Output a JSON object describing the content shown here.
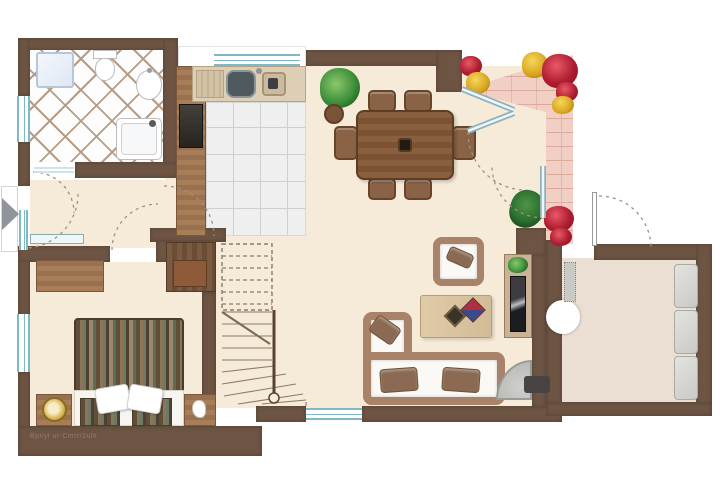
{
  "image_type": "residential ground-floor plan, top-down color rendering",
  "watermark": "Bpl/yl ur Cmrr/2ulk",
  "rooms": [
    {
      "name": "Bathroom",
      "features": [
        "shower cabin",
        "toilet",
        "washbasin",
        "bathtub",
        "diagonal tiled floor",
        "window"
      ]
    },
    {
      "name": "Kitchen",
      "features": [
        "sink counter with two basins",
        "window above counter",
        "tall cabinet column",
        "oven",
        "square tiled floor"
      ]
    },
    {
      "name": "Dining area",
      "features": [
        "dark wood dining table",
        "six chairs",
        "potted plant",
        "round planter"
      ]
    },
    {
      "name": "Terrace",
      "features": [
        "pink brick paving",
        "red flower beds",
        "yellow flower beds",
        "green shrub",
        "diagonal glass double door",
        "second glass door"
      ]
    },
    {
      "name": "Living area",
      "features": [
        "L-shaped corner sofa with white cushions",
        "wicker armchair",
        "light wood coffee table",
        "TV sideboard with plant",
        "corner fireplace with flue"
      ]
    },
    {
      "name": "Hallway",
      "features": [
        "main entrance with glass sidelight",
        "entrance direction arrow",
        "radiator",
        "door swing arcs"
      ]
    },
    {
      "name": "Bedroom",
      "features": [
        "double bed with striped duvet",
        "two white pillows",
        "two nightstands",
        "round bedside lamp",
        "desk",
        "wardrobe",
        "window"
      ]
    },
    {
      "name": "Staircase",
      "features": [
        "winder stairs turning right",
        "dashed upper flight above section cut",
        "railing with newel post",
        "closet nook"
      ]
    },
    {
      "name": "Entry hall",
      "features": [
        "entrance door with swing arc",
        "radiator",
        "glass wardrobe panels",
        "round column fixture"
      ]
    }
  ],
  "counts": {
    "dining_chairs": 6,
    "sofa_cushions": 2,
    "bed_pillows": 2,
    "entry_panels": 3,
    "stair_treads_visible": 11
  },
  "colors": {
    "wall": "#6d5443",
    "interior_floor": "#f6ead8",
    "entry_floor": "#eadfd2",
    "terrace_brick": "#f2cfc5",
    "brick_joint": "#dcab9e",
    "window_glass": "#7fb9c6",
    "wood_furniture": "#a77e58",
    "dark_wood_table": "#7d5336",
    "sofa_wicker": "#a9826a",
    "flower_red": "#b01d31",
    "flower_yellow": "#d9a41f",
    "plant_green": "#3f8f3c",
    "fireplace_gray": "#c2c2be",
    "lamp_gold": "#d9b95c"
  }
}
